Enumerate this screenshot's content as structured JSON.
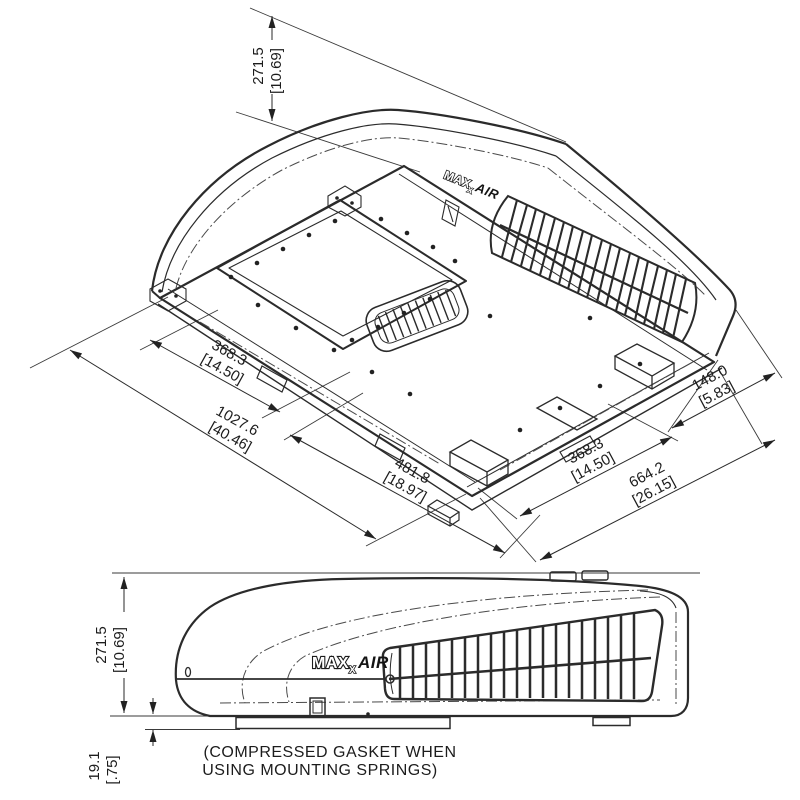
{
  "iso_view": {
    "logo": {
      "main": "MAX",
      "sub": "X",
      "air": "AIR"
    },
    "dims": {
      "height": {
        "mm": "271.5",
        "inch": "[10.69]"
      },
      "opening_front": {
        "mm": "368.3",
        "inch": "[14.50]"
      },
      "overall_length": {
        "mm": "1027.6",
        "inch": "[40.46]"
      },
      "front_section": {
        "mm": "481.8",
        "inch": "[18.97]"
      },
      "opening_side": {
        "mm": "368.3",
        "inch": "[14.50]"
      },
      "overall_width": {
        "mm": "664.2",
        "inch": "[26.15]"
      },
      "side_offset": {
        "mm": "148.0",
        "inch": "[5.83]"
      }
    }
  },
  "side_view": {
    "logo": {
      "main": "MAX",
      "sub": "X",
      "air": "AIR"
    },
    "dims": {
      "height": {
        "mm": "271.5",
        "inch": "[10.69]"
      },
      "gasket": {
        "mm": "19.1",
        "inch": "[.75]"
      }
    },
    "note": {
      "line1": "(COMPRESSED GASKET WHEN",
      "line2": "USING MOUNTING SPRINGS)"
    }
  }
}
